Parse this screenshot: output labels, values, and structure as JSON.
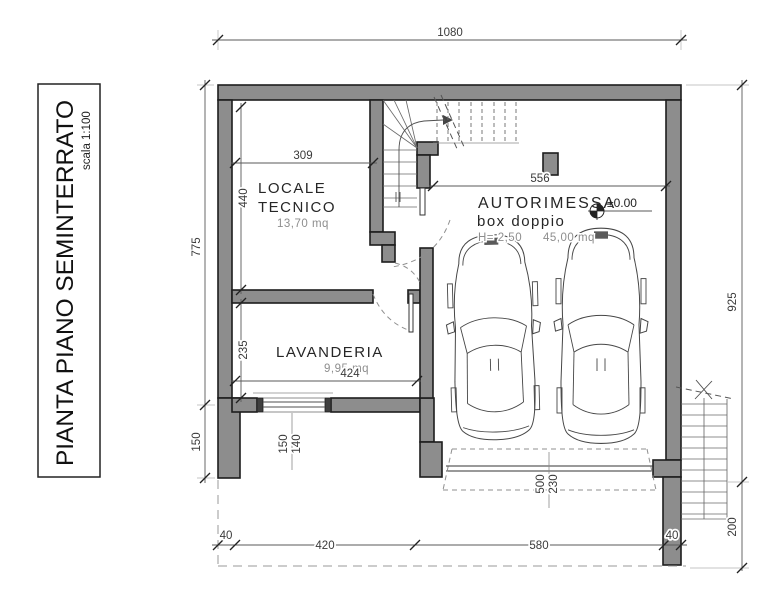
{
  "title_block": {
    "title": "PIANTA PIANO SEMINTERRATO",
    "scale": "scala 1:100"
  },
  "rooms": {
    "locale_tecnico": {
      "name_line1": "LOCALE",
      "name_line2": "TECNICO",
      "area": "13,70 mq"
    },
    "lavanderia": {
      "name": "LAVANDERIA",
      "area": "9,95 mq"
    },
    "autorimessa": {
      "name": "AUTORIMESSA",
      "subtitle": "box doppio",
      "height": "H= 2,50",
      "area": "45,00 mq",
      "level": "±0.00"
    }
  },
  "dims": {
    "top": "1080",
    "left_upper": "775",
    "left_lower": "150",
    "right_upper": "925",
    "right_lower": "200",
    "lt_w": "309",
    "lt_h": "440",
    "lav_h": "235",
    "lav_w": "424",
    "win_w": "150",
    "win_h": "140",
    "gar_w": "556",
    "door_w": "500",
    "door_h": "230",
    "b1": "40",
    "b2": "420",
    "b3": "580",
    "b4": "40"
  },
  "colors": {
    "wall_fill": "#8d8d8d",
    "wall_outline": "#1d1d1d",
    "dim_line": "#5a5a5a",
    "muted_text": "#8e8e8e"
  }
}
